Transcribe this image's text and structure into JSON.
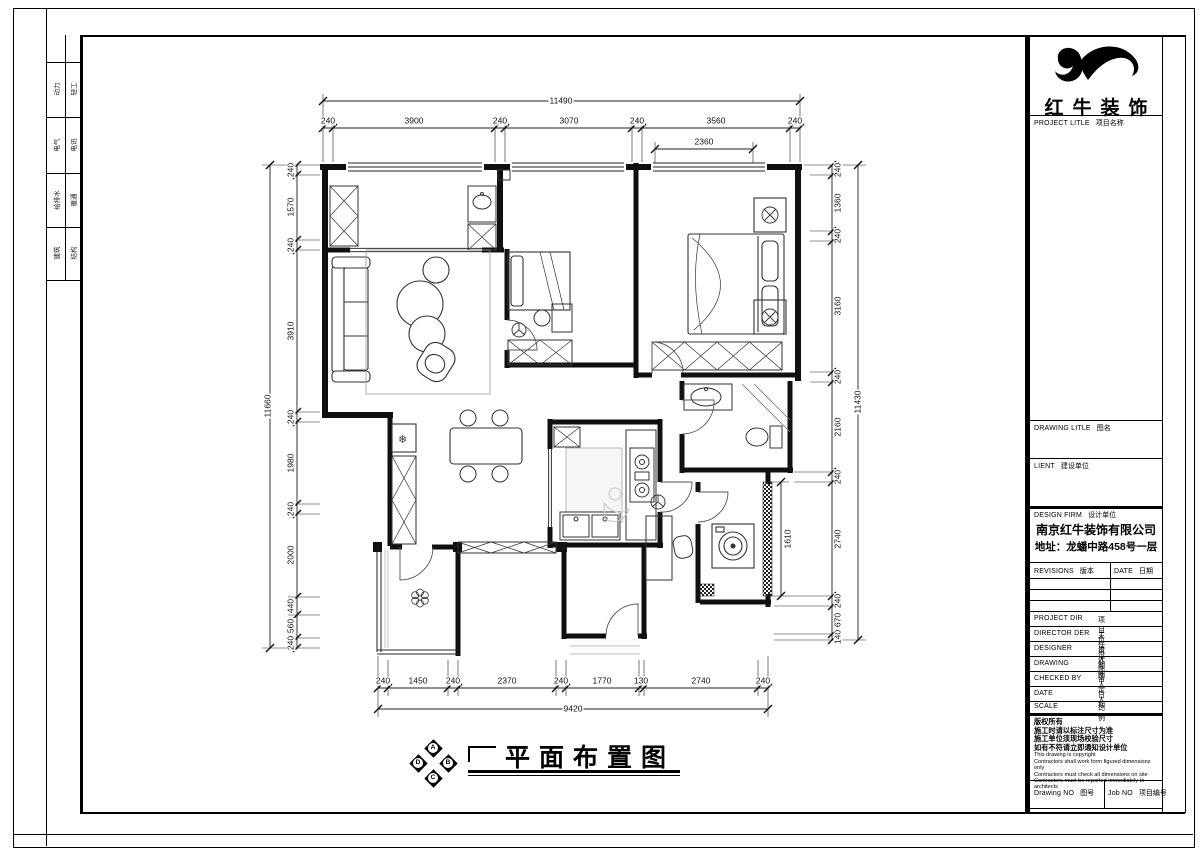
{
  "sheet": {
    "background": "#ffffff",
    "ink": "#000000"
  },
  "margin_strip": {
    "pairs": [
      [
        "动力",
        "轻工"
      ],
      [
        "电气",
        "电讯"
      ],
      [
        "给排水",
        "暖通"
      ],
      [
        "建筑",
        "结构"
      ]
    ]
  },
  "title_block": {
    "brand": "红牛装饰",
    "project_row": {
      "en": "PROJECT LITLE",
      "cn": "项目名称"
    },
    "drawing_row": {
      "en": "DRAWING LITLE",
      "cn": "图名"
    },
    "client_row": {
      "en": "LIENT",
      "cn": "建设单位"
    },
    "firm_row": {
      "en": "DESIGN FIRM",
      "cn": "设计单位"
    },
    "firm_name": "南京红牛装饰有限公司",
    "firm_address": "地址：龙蟠中路458号一层",
    "revisions_head": {
      "en": "REVISIONS",
      "cn": "版本"
    },
    "date_head": {
      "en": "DATE",
      "cn": "日期"
    },
    "staff": [
      {
        "en": "PROJECT DIR",
        "cn": "项目负责人"
      },
      {
        "en": "DIRECTOR DER",
        "cn": "主任设计师"
      },
      {
        "en": "DESIGNER",
        "cn": "设计师"
      },
      {
        "en": "DRAWING",
        "cn": "制图人"
      },
      {
        "en": "CHECKED BY",
        "cn": "审定人"
      },
      {
        "en": "DATE",
        "cn": "日  期"
      },
      {
        "en": "SCALE",
        "cn": "比  例"
      }
    ],
    "notes_cn": [
      "版权所有",
      "施工时请以标注尺寸为准",
      "施工单位须现场校验尺寸",
      "如有不符请立即通知设计单位"
    ],
    "notes_en": [
      "This drawing is copyright",
      "Contractors shall work form figured dimensions only",
      "Contractors must check all dimensions on site",
      "Contractors must be reported immediately to architects"
    ],
    "drawing_no": {
      "en": "Drawing NO",
      "cn": "图号"
    },
    "job_no": {
      "en": "Job NO",
      "cn": "项目编号"
    }
  },
  "plan": {
    "title": "平面布置图",
    "compass_letters": [
      "A",
      "B",
      "C",
      "D"
    ],
    "dims": {
      "top": {
        "overall": "11490",
        "inner": "2360",
        "segments": [
          "240",
          "3900",
          "240",
          "3070",
          "240",
          "3560",
          "240"
        ]
      },
      "left": {
        "overall": "11660",
        "segments": [
          "240",
          "1570",
          "240",
          "3910",
          "240",
          "1980",
          "240",
          "2000",
          "440",
          "560",
          "240"
        ]
      },
      "right": {
        "overall": "11430",
        "inner": "1610",
        "segments": [
          "240",
          "1360",
          "240",
          "3160",
          "240",
          "2160",
          "240",
          "2740",
          "240",
          "670",
          "140"
        ]
      },
      "bottom": {
        "overall": "9420",
        "segments": [
          "240",
          "1450",
          "240",
          "2370",
          "240",
          "1770",
          "130",
          "2740",
          "240"
        ]
      }
    }
  },
  "icons": {
    "snowflake": "❄"
  }
}
